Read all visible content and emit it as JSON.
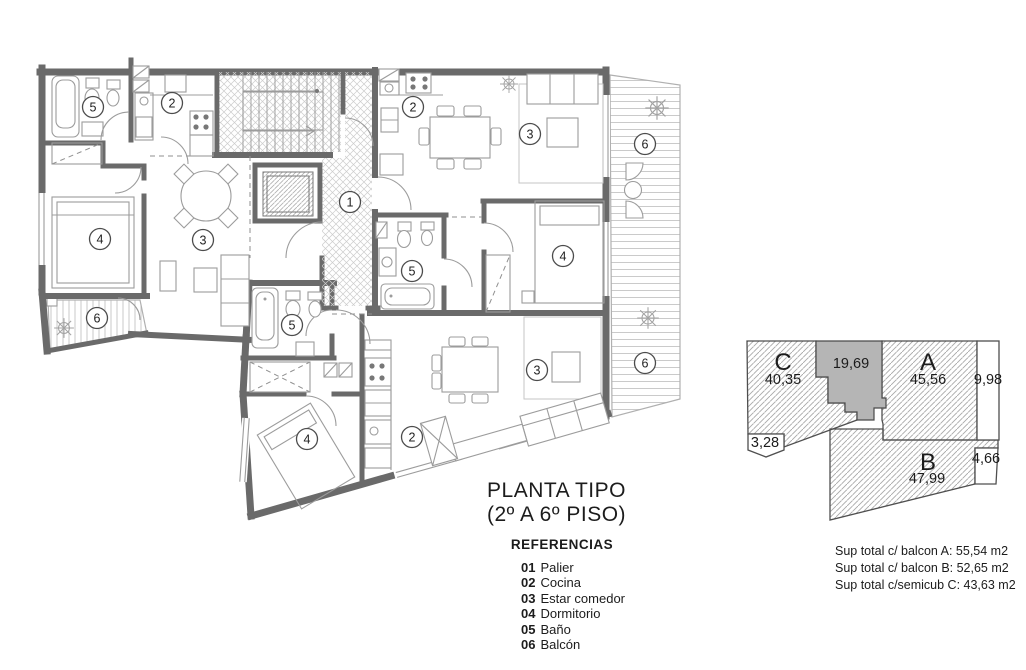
{
  "title": {
    "line1": "PLANTA TIPO",
    "line2": "(2º A 6º PISO)"
  },
  "legend": {
    "heading": "REFERENCIAS",
    "items": [
      {
        "num": "01",
        "label": "Palier"
      },
      {
        "num": "02",
        "label": "Cocina"
      },
      {
        "num": "03",
        "label": "Estar comedor"
      },
      {
        "num": "04",
        "label": "Dormitorio"
      },
      {
        "num": "05",
        "label": "Baño"
      },
      {
        "num": "06",
        "label": "Balcón"
      }
    ]
  },
  "plan": {
    "room_labels": [
      {
        "num": "5",
        "room": "Baño"
      },
      {
        "num": "2",
        "room": "Cocina"
      },
      {
        "num": "2",
        "room": "Cocina"
      },
      {
        "num": "3",
        "room": "Estar comedor"
      },
      {
        "num": "6",
        "room": "Balcón"
      },
      {
        "num": "1",
        "room": "Palier"
      },
      {
        "num": "4",
        "room": "Dormitorio"
      },
      {
        "num": "3",
        "room": "Estar comedor"
      },
      {
        "num": "4",
        "room": "Dormitorio"
      },
      {
        "num": "5",
        "room": "Baño"
      },
      {
        "num": "6",
        "room": "Balcón"
      },
      {
        "num": "5",
        "room": "Baño"
      },
      {
        "num": "6",
        "room": "Balcón"
      },
      {
        "num": "3",
        "room": "Estar comedor"
      },
      {
        "num": "2",
        "room": "Cocina"
      },
      {
        "num": "4",
        "room": "Dormitorio"
      }
    ]
  },
  "key_plan": {
    "units": [
      {
        "id": "C",
        "area": "40,35"
      },
      {
        "id": "A",
        "area": "45,56"
      },
      {
        "id": "B",
        "area": "47,99"
      }
    ],
    "core_area": "19,69",
    "dims": {
      "right_top": "9,98",
      "left": "3,28",
      "right_bottom": "4,66"
    }
  },
  "summary": {
    "lines": [
      "Sup total c/ balcon A:  55,54 m2",
      "Sup total c/ balcon B:  52,65 m2",
      "Sup total c/semicub C:  43,63 m2"
    ]
  },
  "colors": {
    "wall": "#6a6a6a",
    "core_fill": "#b5b5b5",
    "hatch": "#a8a8a8"
  }
}
